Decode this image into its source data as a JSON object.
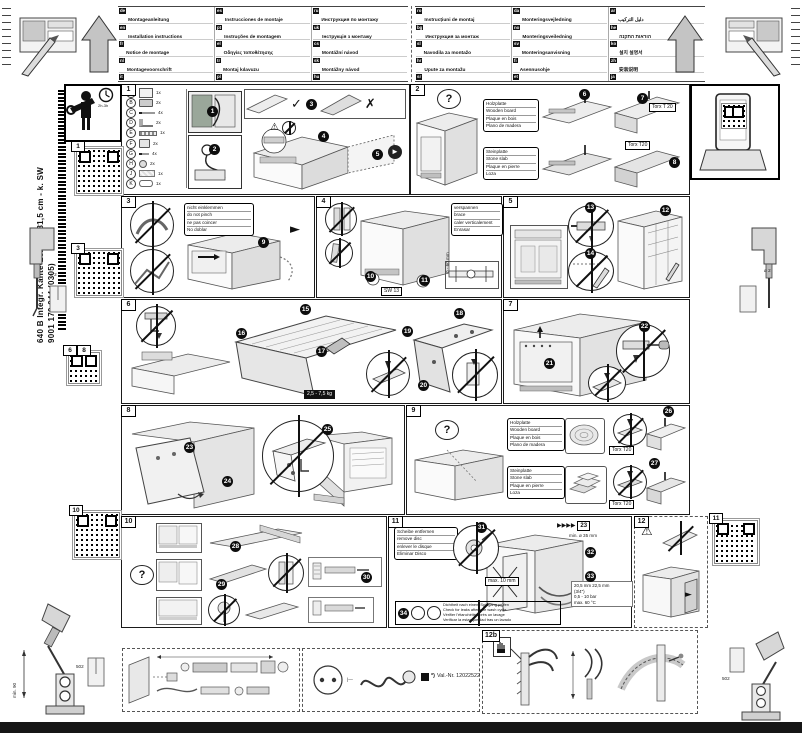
{
  "doc": {
    "model_line": "640 B Integr. Kante-Leisten 81,5 cm - k. SW",
    "order_number": "9001 170 044 (0305)",
    "time_estimate": "2h-3h",
    "valnr_star": "*)",
    "valnr": "Val.-Nr. 12022522"
  },
  "icons": {
    "check": "✓",
    "cross": "✗",
    "warning": "⚠",
    "question": "?",
    "arrow_down": "▼",
    "arrow_right": "►",
    "fast_forward": "▶▶▶▶"
  },
  "qr_labels": {
    "q1": "1",
    "q3": "3",
    "q6": "6",
    "q8": "8",
    "q10": "10",
    "q11": "11"
  },
  "tools": {
    "drill_dia": "ø 2",
    "anchor": "502",
    "depth": "min. 90",
    "torx": "Torx T 20",
    "torx_s": "Torx T20",
    "wrench": "SW 13"
  },
  "surfaces": {
    "wood": [
      "Holzplatte",
      "Wooden board",
      "Plaque en bois",
      "Plano de madera"
    ],
    "stone": [
      "Steinplatte",
      "Stone slab",
      "Plaque en pierre",
      "Loza"
    ]
  },
  "header": {
    "legend_groups": [
      {
        "columns": [
          {
            "items": [
              {
                "code": "de",
                "title": "Montageanleitung",
                "note": "Für späteren Gebrauch aufbewahren"
              },
              {
                "code": "en",
                "title": "Installation instructions",
                "note": "Keep for future use"
              },
              {
                "code": "fr",
                "title": "Notice de montage",
                "note": "À conserver pour consultation"
              },
              {
                "code": "nl",
                "title": "Montagevoorschrift",
                "note": "Bewaren voor later gebruik"
              },
              {
                "code": "it",
                "title": "Istruzioni di montaggio",
                "note": "Conservare per uso futuro"
              }
            ]
          },
          {
            "items": [
              {
                "code": "es",
                "title": "Instrucciones de montaje",
                "note": "Guardar para uso posterior"
              },
              {
                "code": "pt",
                "title": "Instruções de montagem",
                "note": "Guardar para utilização futura"
              },
              {
                "code": "el",
                "title": "Οδηγίες τοποθέτησης",
                "note": "Φυλάξτε τις οδηγίες"
              },
              {
                "code": "tr",
                "title": "Montaj kılavuzu",
                "note": "İleride kullanmak için saklayın"
              },
              {
                "code": "pl",
                "title": "Instrukcja montażu",
                "note": "Zachować do użytku w przyszłości"
              }
            ]
          },
          {
            "items": [
              {
                "code": "ru",
                "title": "Инструкция по монтажу",
                "note": "Сохраните инструкцию"
              },
              {
                "code": "uk",
                "title": "Інструкція з монтажу",
                "note": "Збережіть інструкцію"
              },
              {
                "code": "cs",
                "title": "Montážní návod",
                "note": "Uschovejte pro pozdější použití"
              },
              {
                "code": "sk",
                "title": "Montážny návod",
                "note": "Uschovajte pre neskoršie použitie"
              },
              {
                "code": "hu",
                "title": "Szerelési útmutató",
                "note": "Őrizze meg későbbi használatra"
              }
            ]
          }
        ]
      },
      {
        "columns": [
          {
            "items": [
              {
                "code": "ro",
                "title": "Instrucțiuni de montaj",
                "note": "Păstrați pentru utilizare ulterioară"
              },
              {
                "code": "bg",
                "title": "Инструкция за монтаж",
                "note": "Запазете за бъдеща употреба"
              },
              {
                "code": "sl",
                "title": "Navodila za montažo",
                "note": "Shranite za poznejšo uporabo"
              },
              {
                "code": "hr",
                "title": "Upute za montažu",
                "note": "Sačuvajte za kasniju uporabu"
              },
              {
                "code": "sr",
                "title": "Uputstvo za montažu",
                "note": "Sačuvajte za kasniju upotrebu"
              }
            ]
          },
          {
            "items": [
              {
                "code": "da",
                "title": "Monteringsvejledning",
                "note": "Gem til senere brug"
              },
              {
                "code": "no",
                "title": "Monteringsveiledning",
                "note": "Oppbevar for senere bruk"
              },
              {
                "code": "sv",
                "title": "Monteringsanvisning",
                "note": "Spara för framtida bruk"
              },
              {
                "code": "fi",
                "title": "Asennusohje",
                "note": "Säilytä myöhempää käyttöä varten"
              },
              {
                "code": "et",
                "title": "Paigaldusjuhend",
                "note": "Hoidke edaspidiseks alles"
              }
            ]
          },
          {
            "items": [
              {
                "code": "ar",
                "title": "دليل التركيب",
                "note": "يُحفظ للاستخدام اللاحق"
              },
              {
                "code": "he",
                "title": "הוראות התקנה",
                "note": "לשמירה לשימוש עתידי"
              },
              {
                "code": "ko",
                "title": "설치 설명서",
                "note": "나중에 사용할 수 있도록 보관"
              },
              {
                "code": "zh",
                "title": "安装说明",
                "note": "请妥善保管"
              },
              {
                "code": "ja",
                "title": "設置説明書",
                "note": "保管してください"
              }
            ]
          }
        ]
      }
    ]
  },
  "panels": {
    "p1": {
      "num": "1",
      "parts": [
        {
          "id": "A",
          "qty": "1x",
          "kind": "k-template"
        },
        {
          "id": "B",
          "qty": "2x",
          "kind": "k-hinge"
        },
        {
          "id": "C",
          "qty": "4x",
          "kind": "k-screw"
        },
        {
          "id": "D",
          "qty": "2x",
          "kind": "k-bracket"
        },
        {
          "id": "E",
          "qty": "1x",
          "kind": "k-strip"
        },
        {
          "id": "F",
          "qty": "2x",
          "kind": "k-cover"
        },
        {
          "id": "G",
          "qty": "4x",
          "kind": "k-screws"
        },
        {
          "id": "H",
          "qty": "2x",
          "kind": "k-plug"
        },
        {
          "id": "J",
          "qty": "1x",
          "kind": "k-foam"
        },
        {
          "id": "K",
          "qty": "1x",
          "kind": "k-cord"
        }
      ],
      "badges": [
        "1",
        "2",
        "3",
        "4",
        "5"
      ]
    },
    "p2": {
      "num": "2",
      "badges": [
        "6",
        "7",
        "8"
      ]
    },
    "p3": {
      "num": "3",
      "note": [
        "nicht einklemmen",
        "do not pinch",
        "ne pas coincer",
        "No doblar"
      ],
      "badges": [
        "9"
      ]
    },
    "p4": {
      "num": "4",
      "note": [
        "verspannen",
        "brace",
        "caler verticalement",
        "Enrasar"
      ],
      "badges": [
        "10",
        "11"
      ],
      "dim": "0 - 60 mm"
    },
    "p5": {
      "num": "5",
      "badges": [
        "12",
        "13",
        "14"
      ]
    },
    "p6": {
      "num": "6",
      "badges": [
        "15",
        "16",
        "17",
        "18",
        "19",
        "20"
      ],
      "weight": "2,5 - 7,5 kg"
    },
    "p7": {
      "num": "7",
      "badges": [
        "21",
        "22"
      ]
    },
    "p8": {
      "num": "8",
      "badges": [
        "23",
        "24",
        "25"
      ]
    },
    "p9": {
      "num": "9",
      "badges": [
        "26",
        "27"
      ]
    },
    "p10": {
      "num": "10",
      "badges": [
        "28",
        "29",
        "30"
      ]
    },
    "p11": {
      "num": "11",
      "disc_note": [
        "Scheibe entfernen",
        "remove disc",
        "enlever le disque",
        "Eliminar Disco"
      ],
      "leak_note": [
        "Dichtheit nach einem Spülgang prüfen",
        "Check for leaks after one wash cycle",
        "Vérifier l'étanchéité après un lavage",
        "Verificar la estanqueidad tras un lavado"
      ],
      "badges": [
        "31",
        "32",
        "33",
        "34"
      ],
      "max_dim": "max. 10 mm",
      "hole_dim": "min. ø 35 mm",
      "ref": "23",
      "spec": [
        "20,5 mm  22,5 mm",
        "(3/4\")",
        "0,5 - 10 bar",
        "max. 60 °C"
      ]
    },
    "p12": {
      "num": "12"
    },
    "p12b": {
      "num": "12b"
    }
  }
}
